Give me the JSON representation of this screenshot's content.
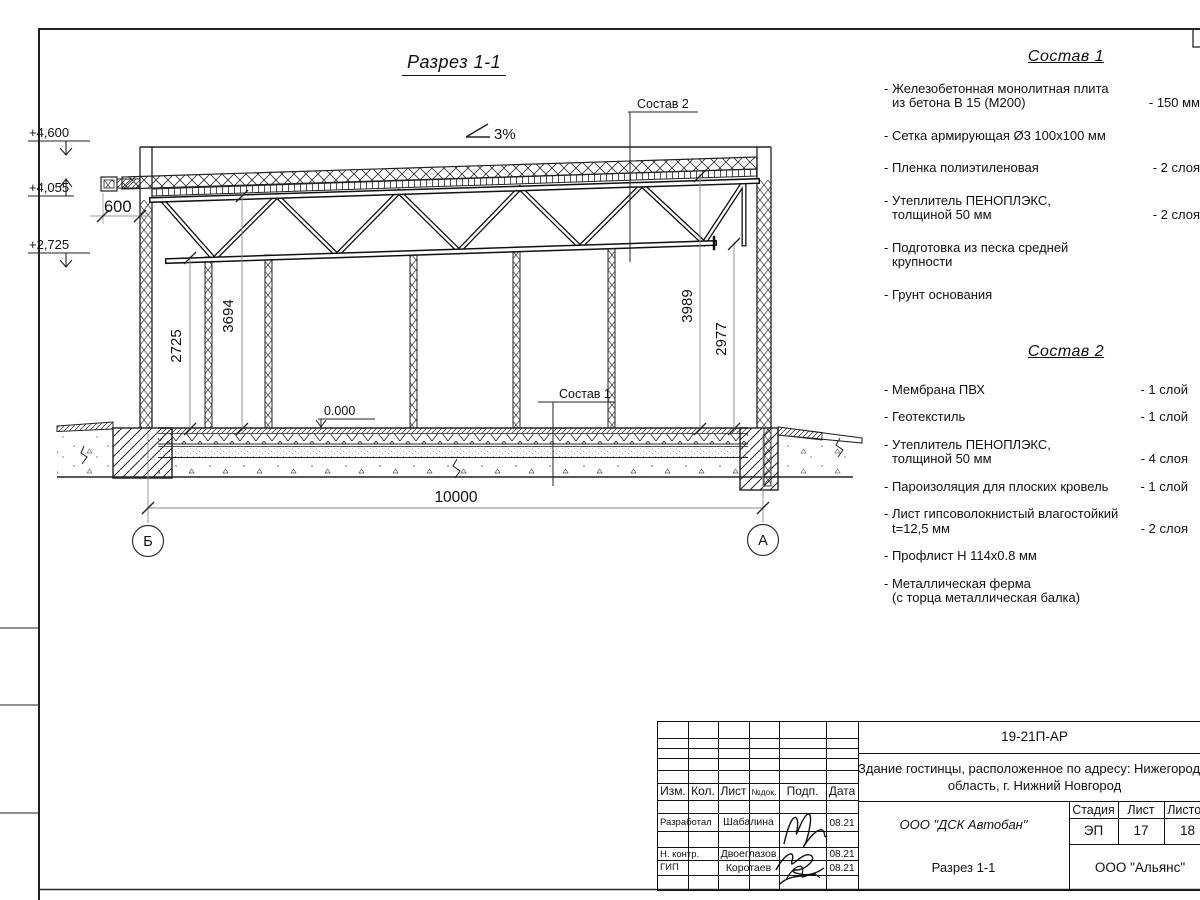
{
  "sheet": {
    "title": "Разрез 1-1",
    "slope": "3%",
    "callout_roof": "Состав 2",
    "callout_floor": "Состав 1",
    "level_top": "+4,600",
    "level_mid": "+4,055",
    "level_low": "+2,725",
    "level_zero": "0.000",
    "dims": {
      "d600": "600",
      "d2725": "2725",
      "d3694": "3694",
      "d3989": "3989",
      "d2977": "2977",
      "d10000": "10000"
    },
    "axis_left": "Б",
    "axis_right": "А"
  },
  "comp1": {
    "title": "Состав 1",
    "items": [
      {
        "l1": "- Железобетонная  монолитная плита",
        "l2": "из бетона В 15 (М200)",
        "value": "- 150 мм"
      },
      {
        "l1": "- Сетка армирующая Ø3 100х100 мм"
      },
      {
        "l1": "- Пленка полиэтиленовая",
        "value": "- 2 слоя"
      },
      {
        "l1": "- Утеплитель ПЕНОПЛЭКС,",
        "l2": "толщиной 50 мм",
        "value": "- 2 слоя"
      },
      {
        "l1": "- Подготовка из песка средней",
        "l2": "крупности",
        "value": "- 200 мм"
      },
      {
        "l1": "- Грунт основания"
      }
    ]
  },
  "comp2": {
    "title": "Состав 2",
    "items": [
      {
        "l1": "- Мембрана ПВХ",
        "value": "- 1 слой"
      },
      {
        "l1": "- Геотекстиль",
        "value": "- 1 слой"
      },
      {
        "l1": "- Утеплитель ПЕНОПЛЭКС,",
        "l2": "толщиной 50 мм",
        "value": "- 4 слоя"
      },
      {
        "l1": "- Пароизоляция для плоских кровель",
        "value": "- 1 слой"
      },
      {
        "l1": "- Лист гипсоволокнистый влагостойкий",
        "l2": "t=12,5 мм",
        "value": "- 2 слоя"
      },
      {
        "l1": "- Профлист Н 114х0.8 мм"
      },
      {
        "l1": "- Металлическая ферма",
        "l2": "(с торца металлическая балка)"
      }
    ]
  },
  "tb": {
    "code": "19-21П-АР",
    "object1": "Здание гостинцы, расположенное по адресу: Нижегородская",
    "object2": "область, г. Нижний Новгород",
    "contractor": "ООО \"ДСК Автобан\"",
    "doc_name": "Разрез 1-1",
    "org": "ООО \"Альянс\"",
    "stage_headers": [
      "Стадия",
      "Лист",
      "Листов"
    ],
    "stage_values": [
      "ЭП",
      "17",
      "18"
    ],
    "columns": [
      "Изм.",
      "Кол.",
      "Лист",
      "№док.",
      "Подп.",
      "Дата"
    ],
    "signers": [
      {
        "role": "Разработал",
        "name": "Шабалина",
        "date": "08.21"
      },
      {
        "role": "Н. контр.",
        "name": "Двоеглазов",
        "date": "08.21"
      },
      {
        "role": "ГИП",
        "name": "Коротаев",
        "date": "08.21"
      }
    ]
  }
}
